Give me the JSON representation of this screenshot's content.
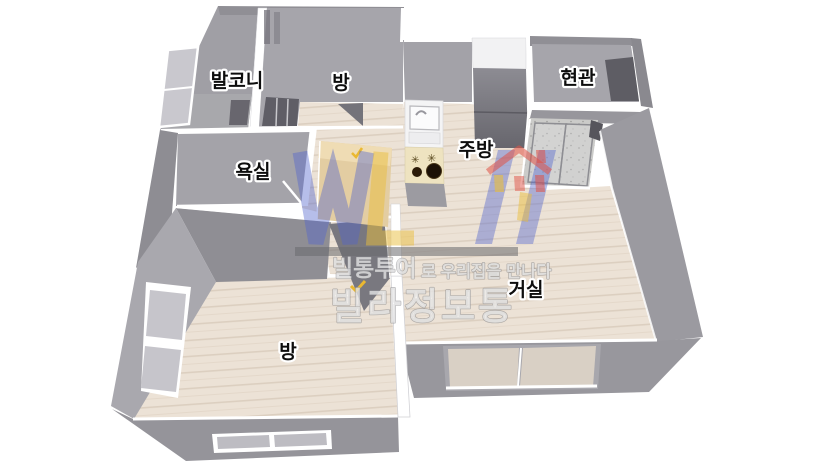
{
  "rooms": {
    "balcony": {
      "label": "발코니"
    },
    "room_top": {
      "label": "방"
    },
    "entrance": {
      "label": "현관"
    },
    "bathroom": {
      "label": "욕실"
    },
    "kitchen": {
      "label": "주방"
    },
    "living_room": {
      "label": "거실"
    },
    "room_bottom": {
      "label": "방"
    }
  },
  "watermark": {
    "tagline_bold": "빌통투어",
    "tagline_rest": "로 우리집을 만나다",
    "brand": "빌라정보통"
  },
  "colors": {
    "wall_face": "#a5a4aa",
    "wall_dark": "#8e8d93",
    "floor_wood": "#ece2d6",
    "balcony_floor": "#a2a2a6",
    "entry_tile": "#c9c9c7",
    "logo_blue": "#5264cd",
    "logo_yellow": "#e9be3c",
    "logo_red": "#e05246",
    "burner_black": "#1c1106"
  }
}
